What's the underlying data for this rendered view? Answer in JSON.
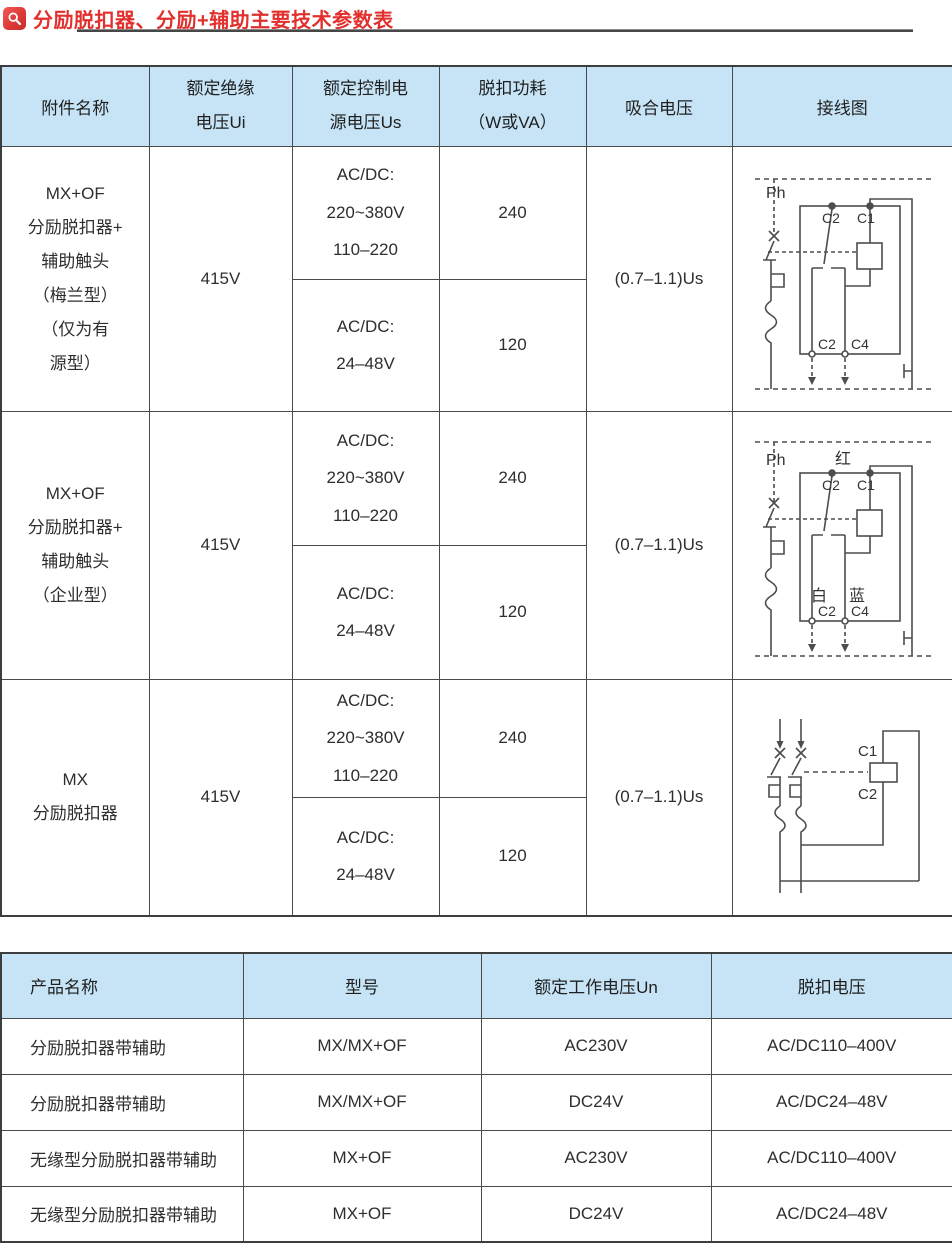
{
  "title": {
    "icon": "magnifier",
    "text": "分励脱扣器、分励+辅助主要技术参数表"
  },
  "colors": {
    "title_red": "#e1302d",
    "header_blue": "#c6e4f6",
    "table_border": "#4a4a4a",
    "diagram_stroke": "#4d4d4d"
  },
  "table1": {
    "headers": [
      "附件名称",
      "额定绝缘\n电压Ui",
      "额定控制电\n源电压Us",
      "脱扣功耗\n（W或VA）",
      "吸合电压",
      "接线图"
    ],
    "rows": [
      {
        "name": "MX+OF\n分励脱扣器+\n辅助触头\n（梅兰型）\n（仅为有\n源型）",
        "ui": "415V",
        "us_high": "AC/DC:\n220~380V\n110–220",
        "power_high": "240",
        "us_low": "AC/DC:\n24–48V",
        "power_low": "120",
        "pickup": "(0.7–1.1)Us"
      },
      {
        "name": "MX+OF\n分励脱扣器+\n辅助触头\n（企业型）",
        "ui": "415V",
        "us_high": "AC/DC:\n220~380V\n110–220",
        "power_high": "240",
        "us_low": "AC/DC:\n24–48V",
        "power_low": "120",
        "pickup": "(0.7–1.1)Us"
      },
      {
        "name": "MX\n分励脱扣器",
        "ui": "415V",
        "us_high": "AC/DC:\n220~380V\n110–220",
        "power_high": "240",
        "us_low": "AC/DC:\n24–48V",
        "power_low": "120",
        "pickup": "(0.7–1.1)Us"
      }
    ]
  },
  "diagrams": {
    "d1": {
      "ph": "Ph",
      "top_c2": "C2",
      "top_c1": "C1",
      "bottom_c2": "C2",
      "bottom_c4": "C4"
    },
    "d2": {
      "ph": "Ph",
      "red": "红",
      "top_c2": "C2",
      "top_c1": "C1",
      "white": "白",
      "blue": "蓝",
      "bottom_c2": "C2",
      "bottom_c4": "C4"
    },
    "d3": {
      "c1": "C1",
      "c2": "C2"
    }
  },
  "table2": {
    "headers": [
      "产品名称",
      "型号",
      "额定工作电压Un",
      "脱扣电压"
    ],
    "rows": [
      [
        "分励脱扣器带辅助",
        "MX/MX+OF",
        "AC230V",
        "AC/DC110–400V"
      ],
      [
        "分励脱扣器带辅助",
        "MX/MX+OF",
        "DC24V",
        "AC/DC24–48V"
      ],
      [
        "无缘型分励脱扣器带辅助",
        "MX+OF",
        "AC230V",
        "AC/DC110–400V"
      ],
      [
        "无缘型分励脱扣器带辅助",
        "MX+OF",
        "DC24V",
        "AC/DC24–48V"
      ]
    ]
  }
}
